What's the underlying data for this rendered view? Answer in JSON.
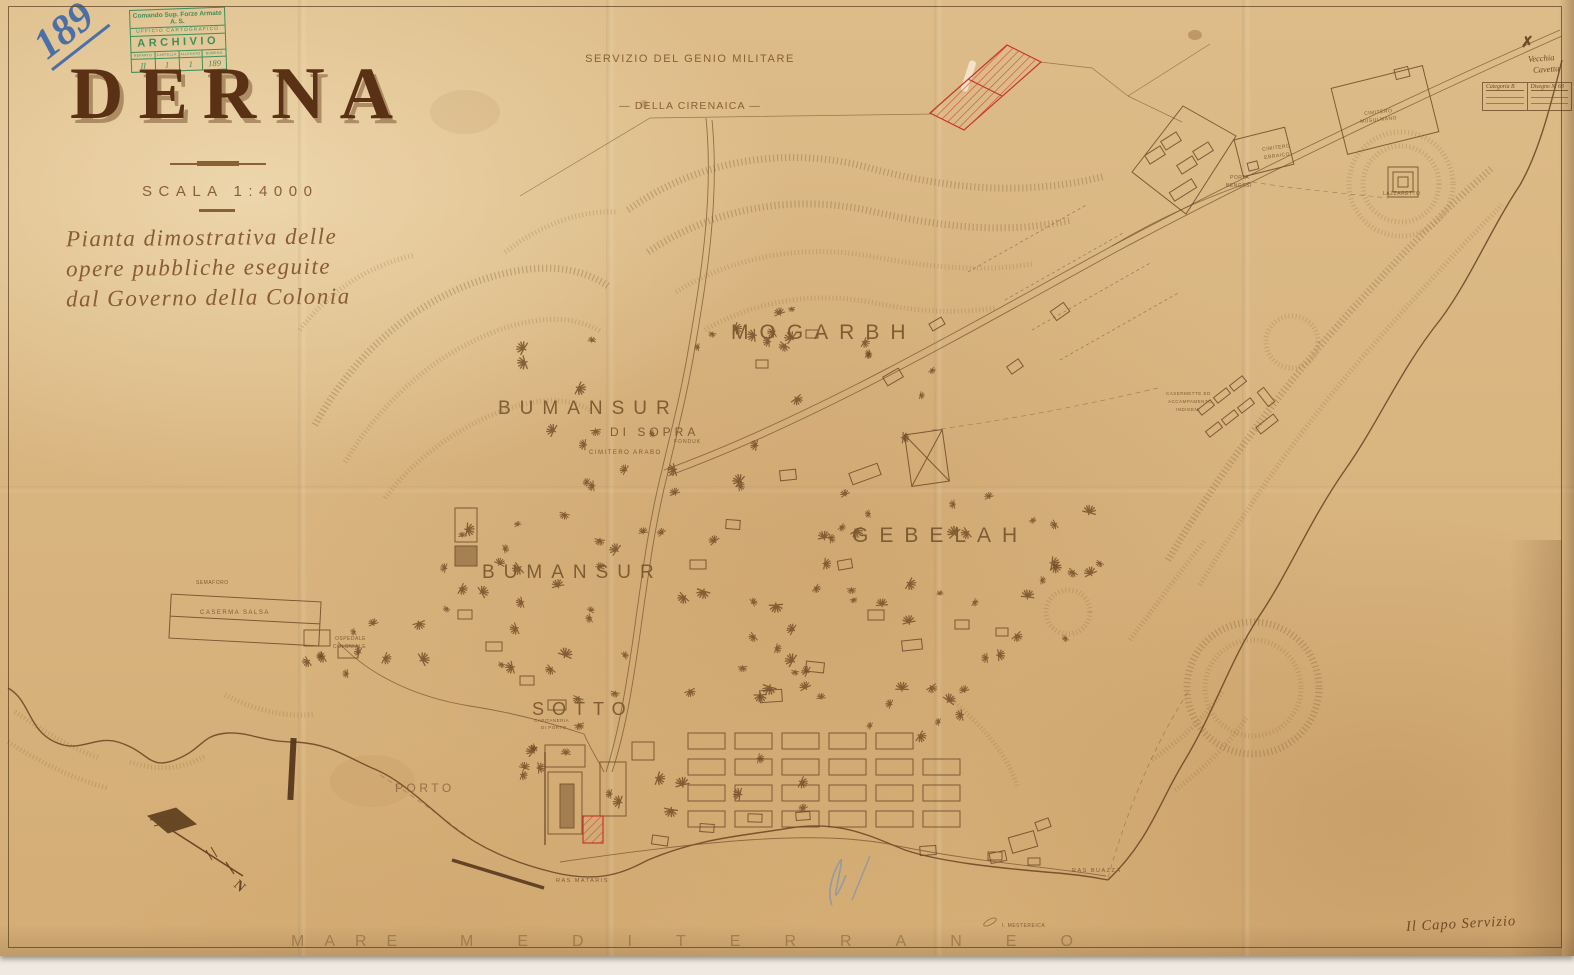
{
  "palette": {
    "paper": "#dcba86",
    "ink": "#7b5a35",
    "ink_dark": "#5d3c1d",
    "title": "#5a3114",
    "label": "#7c5a32",
    "red": "#c63829",
    "stamp": "#2e8a55",
    "blue": "#3a66a8",
    "pencil": "#8295ad"
  },
  "page_number": "189",
  "archive_stamp": {
    "line1": "Comando Sup. Forze Armate A. S.",
    "line2": "UFFICIO CARTOGRAFICO",
    "line3": "ARCHIVIO",
    "columns": [
      "REPARTO",
      "CARTELLA",
      "ALLEGATO",
      "NUMERO"
    ],
    "values": [
      "II",
      "1",
      "1",
      "189"
    ]
  },
  "agency": {
    "line1": "SERVIZIO DEL GENIO MILITARE",
    "line2": "— DELLA CIRENAICA —"
  },
  "title_block": {
    "title": "DERNA",
    "scale": "SCALA 1:4000",
    "subtitle": [
      "Pianta dimostrativa delle",
      "opere pubbliche eseguite",
      "dal Governo della Colonia"
    ]
  },
  "corner_note": {
    "mark": "✗",
    "note_line1": "Vecchia",
    "note_line2": "Cavetta",
    "table_left": "Categoria B",
    "table_right": "Disegno N. 68"
  },
  "compass": {
    "north_label": "N"
  },
  "sea_label": {
    "word1": "MARE",
    "word2": "MEDITERRANEO"
  },
  "signature": "Il Capo Servizio",
  "map_labels": {
    "major": [
      {
        "t": "MOGARBH",
        "x": 731,
        "y": 322,
        "fs": 21,
        "ls": 11
      },
      {
        "t": "BUMANSUR",
        "x": 498,
        "y": 399,
        "fs": 19,
        "ls": 9
      },
      {
        "t": "DI SOPRA",
        "x": 610,
        "y": 426,
        "fs": 12,
        "ls": 4
      },
      {
        "t": "BUMANSUR",
        "x": 482,
        "y": 563,
        "fs": 19,
        "ls": 9
      },
      {
        "t": "SOTTO",
        "x": 532,
        "y": 700,
        "fs": 18,
        "ls": 8
      },
      {
        "t": "GEBELAH",
        "x": 852,
        "y": 525,
        "fs": 21,
        "ls": 11
      },
      {
        "t": "PORTO",
        "x": 395,
        "y": 782,
        "fs": 12,
        "ls": 3.5,
        "op": 0.75
      }
    ],
    "minor": [
      {
        "t": "CIMITERO ARABO",
        "x": 589,
        "y": 450,
        "fs": 6,
        "ls": 1.5
      },
      {
        "t": "FONDUK",
        "x": 674,
        "y": 440,
        "fs": 5,
        "ls": 1
      },
      {
        "t": "SEMAFORO",
        "x": 196,
        "y": 581,
        "fs": 5,
        "ls": 0.5
      },
      {
        "t": "CASERMA SALSA",
        "x": 200,
        "y": 610,
        "fs": 6,
        "ls": 1.5
      },
      {
        "t": "OSPEDALE",
        "x": 335,
        "y": 637,
        "fs": 5,
        "ls": 0.5
      },
      {
        "t": "COLONIALE",
        "x": 333,
        "y": 645,
        "fs": 5,
        "ls": 0.5
      },
      {
        "t": "CAPITANERIA",
        "x": 534,
        "y": 719,
        "fs": 4.5,
        "ls": 0.5
      },
      {
        "t": "DI PORTO",
        "x": 541,
        "y": 726,
        "fs": 4.5,
        "ls": 0.5
      },
      {
        "t": "CIMITERO",
        "x": 1262,
        "y": 148,
        "fs": 5,
        "ls": 0.5,
        "rot": -8
      },
      {
        "t": "EBRAICO",
        "x": 1264,
        "y": 156,
        "fs": 5,
        "ls": 0.5,
        "rot": -8
      },
      {
        "t": "CIMITERO",
        "x": 1364,
        "y": 112,
        "fs": 5,
        "ls": 0.5,
        "rot": -6
      },
      {
        "t": "MUSULMANO",
        "x": 1360,
        "y": 120,
        "fs": 5,
        "ls": 0.5,
        "rot": -6
      },
      {
        "t": "PORTA",
        "x": 1230,
        "y": 176,
        "fs": 5,
        "ls": 0.5
      },
      {
        "t": "BENGASI",
        "x": 1226,
        "y": 184,
        "fs": 5,
        "ls": 0.5
      },
      {
        "t": "LAZZARETTO",
        "x": 1383,
        "y": 192,
        "fs": 5,
        "ls": 0.5
      },
      {
        "t": "CASERMETTE ED",
        "x": 1166,
        "y": 392,
        "fs": 4.5,
        "ls": 0.5
      },
      {
        "t": "ACCAMPAMENTO",
        "x": 1168,
        "y": 400,
        "fs": 4.5,
        "ls": 0.5
      },
      {
        "t": "INDIGENI",
        "x": 1176,
        "y": 408,
        "fs": 4.5,
        "ls": 0.5
      },
      {
        "t": "RAS MATARIS",
        "x": 556,
        "y": 879,
        "fs": 5.5,
        "ls": 1.5
      },
      {
        "t": "RAS BUAZZA",
        "x": 1072,
        "y": 869,
        "fs": 5.5,
        "ls": 1.5
      },
      {
        "t": "I. MESTEREICA",
        "x": 1002,
        "y": 924,
        "fs": 5,
        "ls": 0.5
      }
    ]
  }
}
